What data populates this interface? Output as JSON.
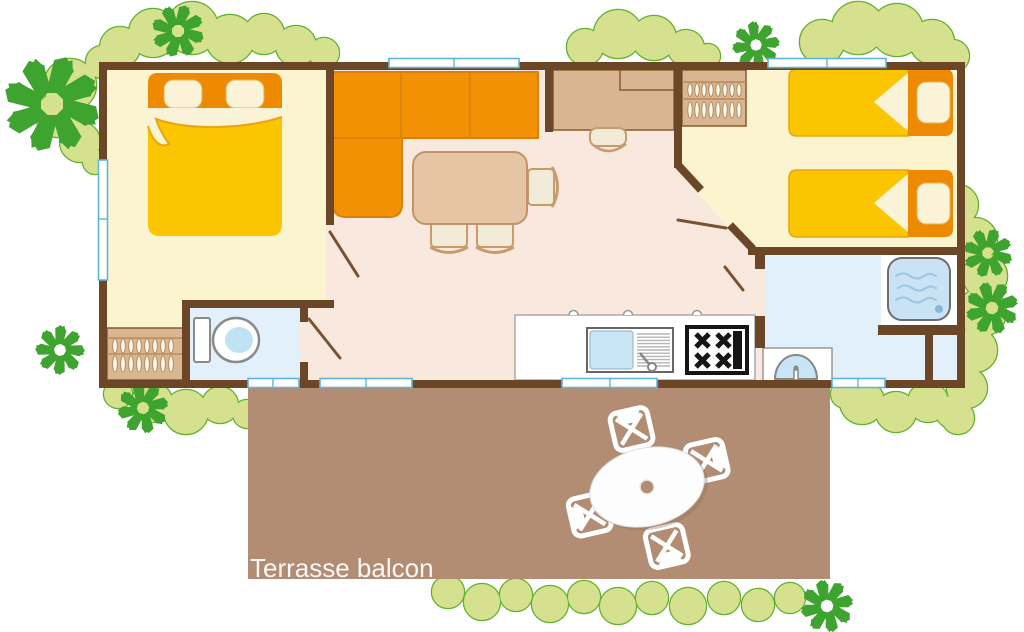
{
  "terrace": {
    "label": "Terrasse balcon"
  },
  "palette": {
    "wall_brown": "#6B4727",
    "bedroom_floor_yellow": "#FBF4CF",
    "living_floor_pink": "#F8E8DE",
    "bathroom_floor_blue": "#E1F0FA",
    "terrace_brown": "#B28C73",
    "furniture_tan": "#D9B691",
    "table_tan": "#E5C5A3",
    "sofa_orange": "#F29104",
    "bed_blanket_yellow": "#FCC502",
    "headboard_orange": "#EE8A00",
    "pillow_cream": "#FAF3D7",
    "tree_green": "#3EA32F",
    "bush_green": "#D6E18F",
    "bush_outline_green": "#63B22F",
    "window_blue": "#5FB5DC",
    "stove_black": "#151515",
    "label_text": "#FBF8F5"
  }
}
